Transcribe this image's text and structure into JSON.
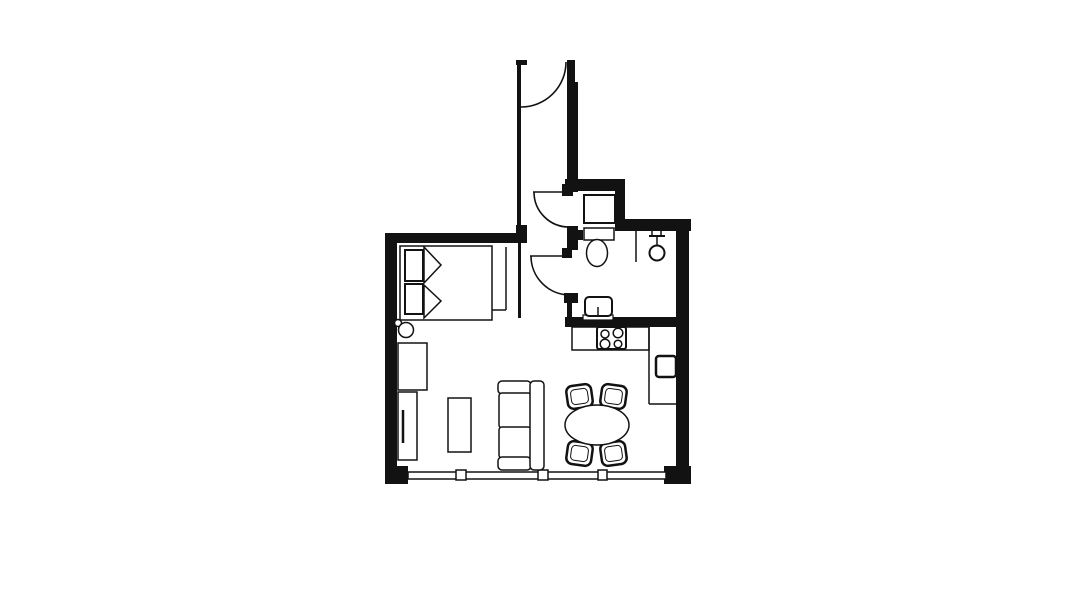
{
  "canvas": {
    "width": 1092,
    "height": 614,
    "background": "#ffffff",
    "ink": "#121212"
  },
  "floor_plan": {
    "elements": [
      {
        "name": "wall-top-left",
        "t": "wall",
        "x": 385,
        "y": 233,
        "w": 136,
        "h": 10
      },
      {
        "name": "wall-hall-stub",
        "t": "wall",
        "x": 516,
        "y": 225,
        "w": 11,
        "h": 18
      },
      {
        "name": "wall-left",
        "t": "wall",
        "x": 385,
        "y": 233,
        "w": 12,
        "h": 239
      },
      {
        "name": "wall-corner-bottom-left",
        "t": "wall",
        "x": 385,
        "y": 466,
        "w": 23,
        "h": 18
      },
      {
        "name": "wall-corner-bottom-right",
        "t": "wall",
        "x": 664,
        "y": 466,
        "w": 27,
        "h": 18
      },
      {
        "name": "wall-right",
        "t": "wall",
        "x": 676,
        "y": 219,
        "w": 13,
        "h": 265
      },
      {
        "name": "wall-top-right",
        "t": "wall",
        "x": 615,
        "y": 219,
        "w": 76,
        "h": 12
      },
      {
        "name": "wall-bathroom-top",
        "t": "wall",
        "x": 565,
        "y": 179,
        "w": 60,
        "h": 12
      },
      {
        "name": "wall-bathroom-right-stub",
        "t": "wall",
        "x": 615,
        "y": 179,
        "w": 10,
        "h": 46
      },
      {
        "name": "wall-corridor-right-upper",
        "t": "wall",
        "x": 567,
        "y": 60,
        "w": 8,
        "h": 24
      },
      {
        "name": "wall-corridor-right",
        "t": "wall",
        "x": 567,
        "y": 82,
        "w": 11,
        "h": 110
      },
      {
        "name": "wall-door-upper-jamb",
        "t": "wall",
        "x": 562,
        "y": 184,
        "w": 11,
        "h": 12
      },
      {
        "name": "wall-between-doors",
        "t": "wall",
        "x": 567,
        "y": 226,
        "w": 11,
        "h": 24
      },
      {
        "name": "wall-door-lower-jamb-top",
        "t": "wall",
        "x": 562,
        "y": 248,
        "w": 10,
        "h": 10
      },
      {
        "name": "wall-toilet-stub",
        "t": "wall",
        "x": 573,
        "y": 230,
        "w": 10,
        "h": 10
      },
      {
        "name": "wall-door-lower-jamb-bottom",
        "t": "wall",
        "x": 564,
        "y": 293,
        "w": 14,
        "h": 10
      },
      {
        "name": "wall-bathroom-left-lower",
        "t": "wall",
        "x": 567,
        "y": 303,
        "w": 5,
        "h": 24
      },
      {
        "name": "wall-kitchen",
        "t": "wall",
        "x": 565,
        "y": 317,
        "w": 111,
        "h": 10
      },
      {
        "name": "wall-corridor-left-thin",
        "t": "wall",
        "x": 517,
        "y": 64,
        "w": 4,
        "h": 161
      },
      {
        "name": "wall-entry-stub",
        "t": "wall",
        "x": 516,
        "y": 60,
        "w": 11,
        "h": 5
      },
      {
        "name": "wall-hall-left-lower",
        "t": "wall",
        "x": 518,
        "y": 243,
        "w": 3,
        "h": 75
      },
      {
        "name": "window-band",
        "t": "rect",
        "x": 408,
        "y": 472,
        "w": 258,
        "h": 7,
        "sw": 1.5
      },
      {
        "name": "window-mullion-1",
        "t": "rect",
        "x": 456,
        "y": 470,
        "w": 10,
        "h": 10,
        "sw": 1.5
      },
      {
        "name": "window-mullion-2",
        "t": "rect",
        "x": 538,
        "y": 470,
        "w": 10,
        "h": 10,
        "sw": 1.5
      },
      {
        "name": "window-mullion-3",
        "t": "rect",
        "x": 598,
        "y": 470,
        "w": 9,
        "h": 10,
        "sw": 1.5
      },
      {
        "name": "entry-door-swing",
        "t": "path",
        "d": "M 566 62 A 45 45 0 0 1 521 107",
        "sw": 1.6
      },
      {
        "name": "bathroom-door-upper-leaf",
        "t": "line",
        "p": [
          533,
          192,
          569,
          192
        ],
        "sw": 1.6
      },
      {
        "name": "bathroom-door-upper-swing",
        "t": "path",
        "d": "M 534 192 A 35 35 0 0 0 569 227",
        "sw": 1.6
      },
      {
        "name": "bathroom-door-lower-leaf",
        "t": "line",
        "p": [
          530,
          256,
          570,
          256
        ],
        "sw": 1.6
      },
      {
        "name": "bathroom-door-lower-swing",
        "t": "path",
        "d": "M 531 256 A 39 39 0 0 0 570 295",
        "sw": 1.6
      },
      {
        "name": "closet-side-line",
        "t": "line",
        "p": [
          506,
          247,
          506,
          310
        ],
        "sw": 1.5
      },
      {
        "name": "closet-front-line",
        "t": "line",
        "p": [
          492,
          310,
          506,
          310
        ],
        "sw": 1.5
      },
      {
        "name": "bed",
        "t": "rect",
        "x": 400,
        "y": 246,
        "w": 92,
        "h": 74,
        "sw": 1.5
      },
      {
        "name": "bed-pillow-top",
        "t": "rect",
        "x": 405,
        "y": 250,
        "w": 18,
        "h": 31,
        "sw": 2
      },
      {
        "name": "bed-pillow-bottom",
        "t": "rect",
        "x": 405,
        "y": 284,
        "w": 18,
        "h": 30,
        "sw": 2
      },
      {
        "name": "bed-blanket-fold-top",
        "t": "poly",
        "pts": "424,247 441,265 424,283",
        "sw": 1.5
      },
      {
        "name": "bed-blanket-fold-bottom",
        "t": "poly",
        "pts": "424,285 441,301 424,318",
        "sw": 1.5
      },
      {
        "name": "floor-lamp-small-circle",
        "t": "circle",
        "cx": 398,
        "cy": 323,
        "r": 3.5,
        "sw": 1.5
      },
      {
        "name": "floor-lamp-large-circle",
        "t": "circle",
        "cx": 406,
        "cy": 330,
        "r": 7.5,
        "sw": 1.5
      },
      {
        "name": "wardrobe",
        "t": "rect",
        "x": 398,
        "y": 343,
        "w": 29,
        "h": 47,
        "sw": 1.5
      },
      {
        "name": "tv-board",
        "t": "rect",
        "x": 398,
        "y": 392,
        "w": 19,
        "h": 68,
        "sw": 1.5
      },
      {
        "name": "tv",
        "t": "line",
        "p": [
          403,
          410,
          403,
          443
        ],
        "sw": 2.5
      },
      {
        "name": "coffee-table",
        "t": "rect",
        "x": 448,
        "y": 398,
        "w": 23,
        "h": 54,
        "sw": 1.5
      },
      {
        "name": "sofa-armrest-top",
        "t": "rect",
        "x": 498,
        "y": 381,
        "w": 33,
        "h": 13,
        "rx": 4,
        "sw": 1.5
      },
      {
        "name": "sofa-cushion-top",
        "t": "rect",
        "x": 499,
        "y": 393,
        "w": 32,
        "h": 35,
        "rx": 3,
        "sw": 1.5
      },
      {
        "name": "sofa-cushion-bottom",
        "t": "rect",
        "x": 499,
        "y": 427,
        "w": 32,
        "h": 31,
        "rx": 3,
        "sw": 1.5
      },
      {
        "name": "sofa-armrest-bottom",
        "t": "rect",
        "x": 498,
        "y": 457,
        "w": 33,
        "h": 13,
        "rx": 4,
        "sw": 1.5
      },
      {
        "name": "sofa-backrest",
        "t": "rect",
        "x": 530,
        "y": 381,
        "w": 14,
        "h": 89,
        "rx": 4,
        "sw": 1.5
      },
      {
        "name": "dining-chair-top-left",
        "t": "rect",
        "x": 567,
        "y": 385,
        "w": 25,
        "h": 23,
        "rx": 6,
        "sw": 2.5,
        "rot": -8
      },
      {
        "name": "dining-chair-top-left-inner",
        "t": "rect",
        "x": 571,
        "y": 389,
        "w": 17,
        "h": 15,
        "rx": 4,
        "sw": 1,
        "rot": -8
      },
      {
        "name": "dining-chair-top-right",
        "t": "rect",
        "x": 601,
        "y": 385,
        "w": 25,
        "h": 23,
        "rx": 6,
        "sw": 2.5,
        "rot": 8
      },
      {
        "name": "dining-chair-top-right-inner",
        "t": "rect",
        "x": 605,
        "y": 389,
        "w": 17,
        "h": 15,
        "rx": 4,
        "sw": 1,
        "rot": 8
      },
      {
        "name": "dining-chair-bottom-left",
        "t": "rect",
        "x": 567,
        "y": 442,
        "w": 25,
        "h": 23,
        "rx": 6,
        "sw": 2.5,
        "rot": 8
      },
      {
        "name": "dining-chair-bottom-left-inner",
        "t": "rect",
        "x": 571,
        "y": 446,
        "w": 17,
        "h": 15,
        "rx": 4,
        "sw": 1,
        "rot": 8
      },
      {
        "name": "dining-chair-bottom-right",
        "t": "rect",
        "x": 601,
        "y": 442,
        "w": 25,
        "h": 23,
        "rx": 6,
        "sw": 2.5,
        "rot": -8
      },
      {
        "name": "dining-chair-bottom-right-inner",
        "t": "rect",
        "x": 605,
        "y": 446,
        "w": 17,
        "h": 15,
        "rx": 4,
        "sw": 1,
        "rot": -8
      },
      {
        "name": "dining-table",
        "t": "ellipse",
        "cx": 597,
        "cy": 425,
        "rx": 32,
        "ry": 20,
        "sw": 1.5
      },
      {
        "name": "washing-machine",
        "t": "rect",
        "x": 584,
        "y": 195,
        "w": 31,
        "h": 28,
        "sw": 2
      },
      {
        "name": "toilet-cistern",
        "t": "rect",
        "x": 584,
        "y": 228,
        "w": 30,
        "h": 12,
        "sw": 1.5
      },
      {
        "name": "toilet-bowl",
        "t": "ellipse",
        "cx": 597,
        "cy": 253,
        "rx": 10.5,
        "ry": 13.5,
        "sw": 1.5
      },
      {
        "name": "shower-divider",
        "t": "line",
        "p": [
          636,
          231,
          636,
          262
        ],
        "sw": 1.5
      },
      {
        "name": "shower-arm-bar",
        "t": "line",
        "p": [
          649,
          236,
          665,
          236
        ],
        "sw": 2
      },
      {
        "name": "shower-tick-left",
        "t": "line",
        "p": [
          652,
          230,
          652,
          236
        ],
        "sw": 1.5
      },
      {
        "name": "shower-tick-right",
        "t": "line",
        "p": [
          661,
          230,
          661,
          236
        ],
        "sw": 1.5
      },
      {
        "name": "shower-stem",
        "t": "line",
        "p": [
          657,
          236,
          657,
          247
        ],
        "sw": 1.5
      },
      {
        "name": "shower-head",
        "t": "circle",
        "cx": 657,
        "cy": 253,
        "r": 7.5,
        "sw": 2
      },
      {
        "name": "bathroom-sink-base",
        "t": "rect",
        "x": 583,
        "y": 315,
        "w": 30,
        "h": 5,
        "sw": 1.2
      },
      {
        "name": "bathroom-sink",
        "t": "rect",
        "x": 585,
        "y": 297,
        "w": 27,
        "h": 19,
        "rx": 4,
        "sw": 2
      },
      {
        "name": "bathroom-sink-faucet",
        "t": "line",
        "p": [
          598,
          307,
          598,
          316
        ],
        "sw": 1.5
      },
      {
        "name": "kitchen-counter",
        "t": "rect",
        "x": 572,
        "y": 327,
        "w": 77,
        "h": 23,
        "sw": 1.5
      },
      {
        "name": "stove",
        "t": "rect",
        "x": 597,
        "y": 327,
        "w": 29,
        "h": 22,
        "rx": 2,
        "sw": 2
      },
      {
        "name": "stove-burner-1",
        "t": "circle",
        "cx": 605,
        "cy": 334,
        "r": 4,
        "sw": 1.5
      },
      {
        "name": "stove-burner-2",
        "t": "circle",
        "cx": 618,
        "cy": 333,
        "r": 4.8,
        "sw": 1.5
      },
      {
        "name": "stove-burner-3",
        "t": "circle",
        "cx": 605,
        "cy": 344,
        "r": 4.8,
        "sw": 1.5
      },
      {
        "name": "stove-burner-4",
        "t": "circle",
        "cx": 618,
        "cy": 344,
        "r": 3.8,
        "sw": 1.5
      },
      {
        "name": "tall-unit-side",
        "t": "line",
        "p": [
          649,
          327,
          649,
          404
        ],
        "sw": 1.5
      },
      {
        "name": "tall-unit-front",
        "t": "line",
        "p": [
          649,
          404,
          676,
          404
        ],
        "sw": 1.5
      },
      {
        "name": "fridge",
        "t": "rect",
        "x": 656,
        "y": 356,
        "w": 20,
        "h": 21,
        "rx": 3,
        "sw": 2.5
      },
      {
        "name": "fridge-door-tick",
        "t": "line",
        "p": [
          676,
          366,
          680,
          366
        ],
        "sw": 1.5
      }
    ]
  }
}
